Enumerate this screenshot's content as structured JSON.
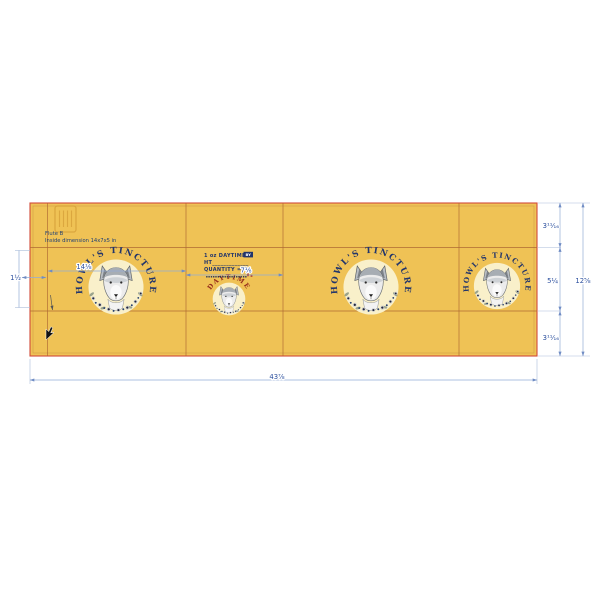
{
  "board_notes": {
    "flute": "Flute B",
    "inside_dimension": "Inside dimension 14x7x5  in"
  },
  "branding": {
    "arc_text": "HOWL'S TINCTURE",
    "daytime_arc_text": "DAYTIME",
    "panel2_line1": "1 oz DAYTIME",
    "panel2_line1_tag": "BY",
    "panel2_line2": "HT_____________",
    "panel2_line3": "QUANTITY = 50",
    "panel2_micro_text": "▪▪▪▪▪▪▪▪▪▪▪▪▪▪▪▪▪▪"
  },
  "dimensions": {
    "overall_width": "43⅞",
    "overall_height": "12⅝",
    "top_flap_height": "3¹¹⁄₁₆",
    "panel_height": "5¼",
    "bottom_flap_height": "3¹¹⁄₁₆",
    "glue_flap_width": "1½",
    "panel1_width": "14⅛",
    "panel2_width": "7⅛"
  },
  "colors": {
    "board_fill": "#efc255",
    "cut_line": "#d14b3a",
    "inner_offset_line": "#c9953f",
    "fold_line": "#b06a33",
    "dimension_line": "#93abd6",
    "dimension_text": "#2b4f9e",
    "note_text": "#1c3f77",
    "brand_navy": "#22356b",
    "daytime_red": "#962c1c",
    "emblem_circle": "#f9f0ca",
    "watermark": "#d8a33c"
  }
}
